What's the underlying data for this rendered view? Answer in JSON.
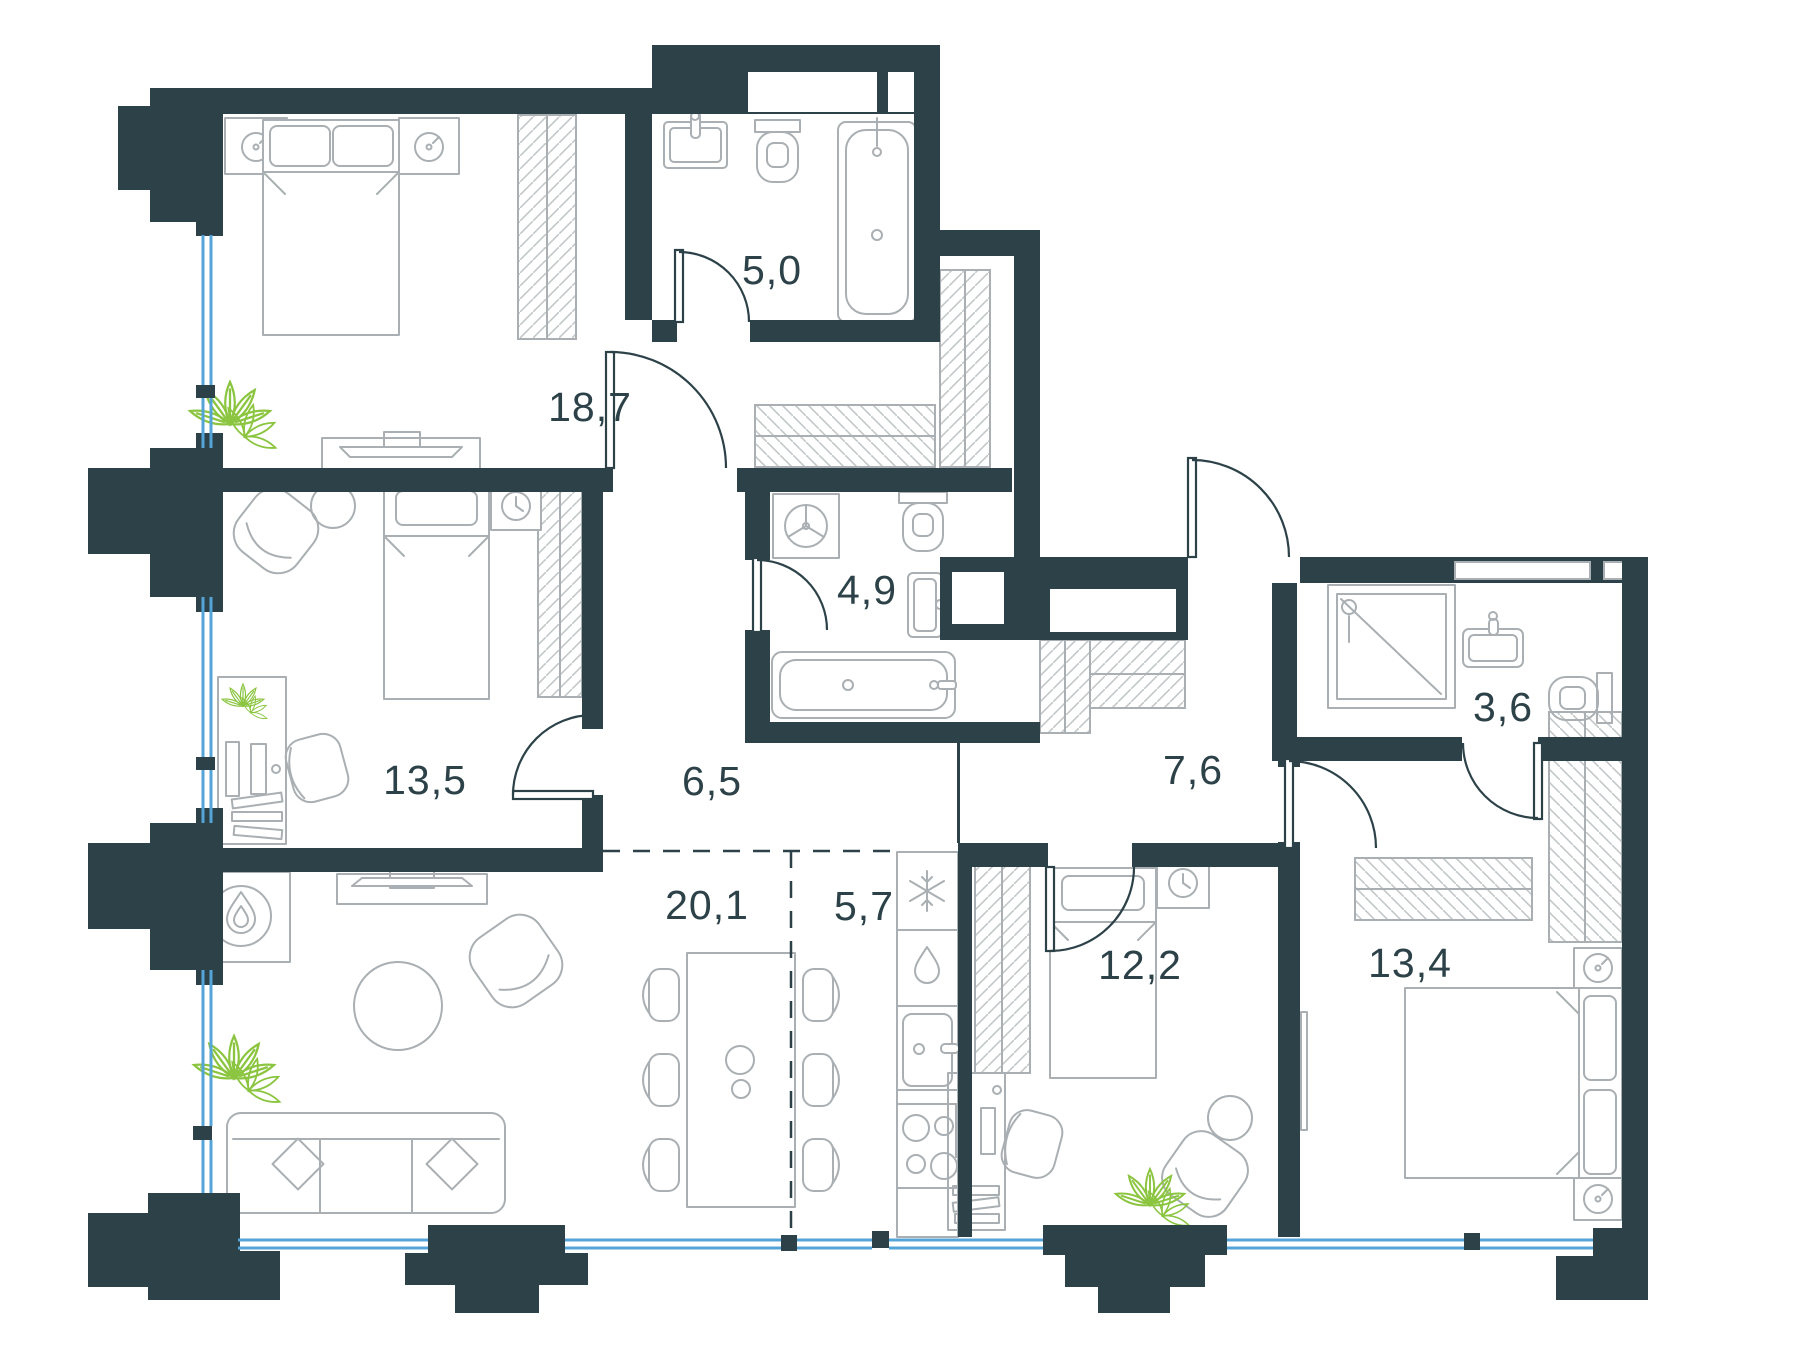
{
  "floorplan": {
    "type": "apartment-floor-plan",
    "rooms": [
      {
        "id": "bedroom-master",
        "area": "18,7"
      },
      {
        "id": "bathroom-ensuite",
        "area": "5,0"
      },
      {
        "id": "bathroom-main",
        "area": "4,9"
      },
      {
        "id": "bedroom-left",
        "area": "13,5"
      },
      {
        "id": "hallway-inner",
        "area": "6,5"
      },
      {
        "id": "hallway-entry",
        "area": "7,6"
      },
      {
        "id": "bathroom-guest",
        "area": "3,6"
      },
      {
        "id": "living-room",
        "area": "20,1"
      },
      {
        "id": "kitchen",
        "area": "5,7"
      },
      {
        "id": "bedroom-middle",
        "area": "12,2"
      },
      {
        "id": "bedroom-right",
        "area": "13,4"
      }
    ],
    "colors": {
      "wall": "#2C4248",
      "furniture_line": "#A9AFB2",
      "window": "#54A4D8",
      "plant": "#8BC540",
      "label_text": "#2C4248",
      "background": "#FFFFFF"
    }
  }
}
